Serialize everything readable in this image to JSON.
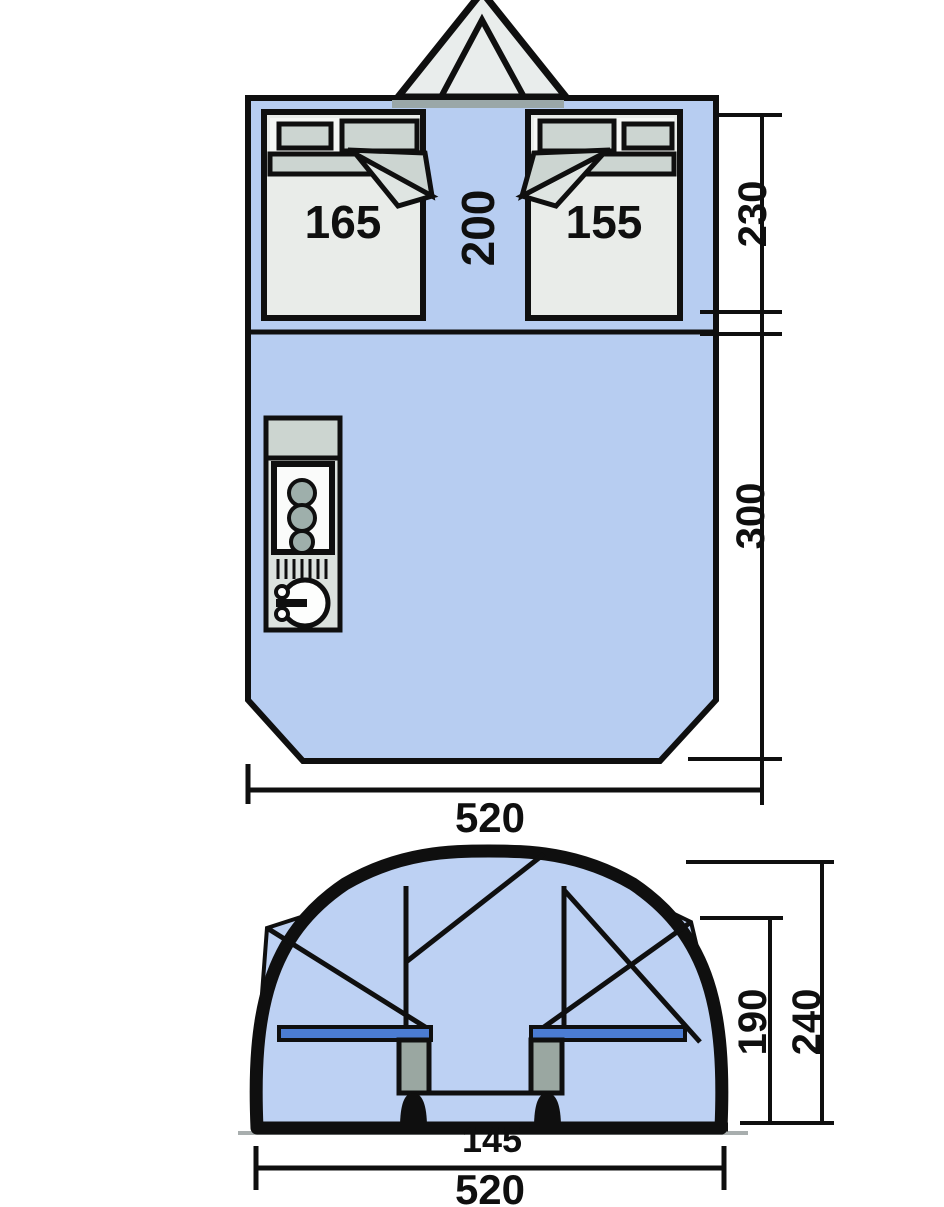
{
  "diagram_title": "tent-floor-plan-and-elevation",
  "colors": {
    "blue": "#b7cdf1",
    "dome_blue": "#bdd1f3",
    "outline": "#0f0f0f",
    "cabin": "#e9ece9",
    "pad": "#ccd5d1",
    "pad_light": "#dfe5e2",
    "band": "#f5f7f5",
    "awning": "#e9edec",
    "kitchen": "#dce2de",
    "worktop": "#ccd5d0",
    "burner": "#9eafab",
    "stove_white": "#fafbfa",
    "sink_white": "#fdfefd",
    "bed_bar": "#4b7cd2",
    "leg": "#9aa7a1",
    "threshold": "#9aa7a8",
    "shadow": "#a8aeae"
  },
  "floorplan": {
    "left_cabin": "165",
    "right_cabin": "155",
    "corridor": "200",
    "sleep_depth": "230",
    "living_depth": "300",
    "width": "520"
  },
  "elevation": {
    "inner_height": "190",
    "total_height": "240",
    "inner_width": "145",
    "width": "520"
  }
}
